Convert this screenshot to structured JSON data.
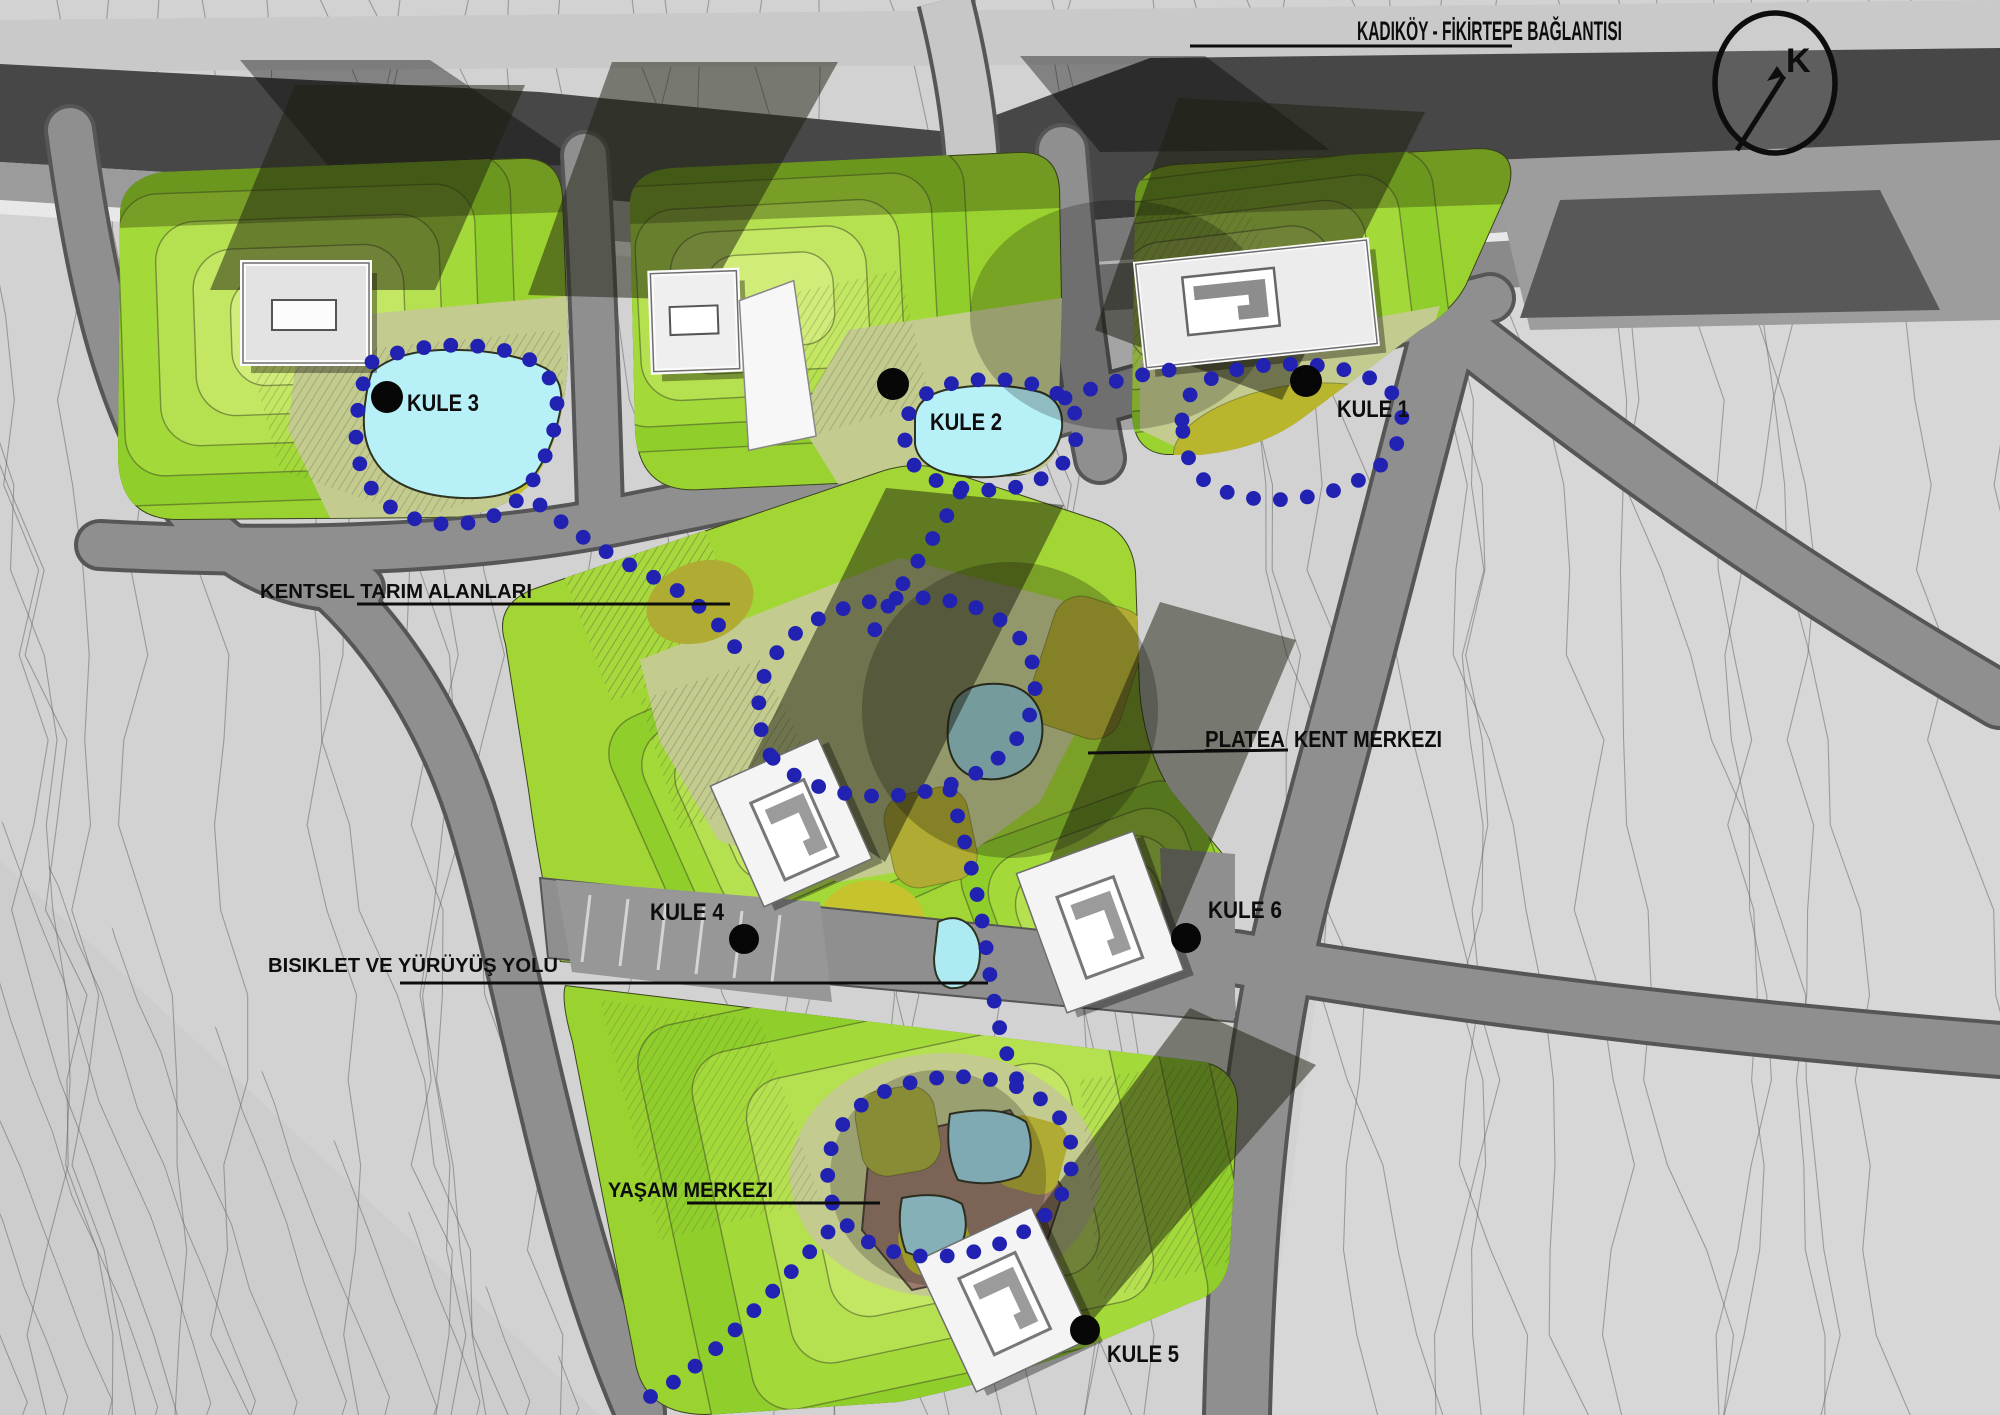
{
  "title": "PLATEA Kent Merkezi vaziyet planı",
  "labels": {
    "connection": "KADIKÖY - FİKİRTEPE BAĞLANTISI",
    "kule1": "KULE 1",
    "kule2": "KULE 2",
    "kule3": "KULE 3",
    "kule4": "KULE 4",
    "kule5": "KULE 5",
    "kule6": "KULE 6",
    "farming": "KENTSEL TARIM ALANLARI",
    "platea": "PLATEA",
    "kent_merkezi": "KENT MERKEZI",
    "bike": "BISIKLET VE YÜRÜYÜŞ YOLU",
    "life_center": "YAŞAM MERKEZI"
  },
  "compass": {
    "letter": "K"
  },
  "colors": {
    "background": "#d2d2d2",
    "contour_line": "#5f5f5f",
    "highway_dark": "#474747",
    "road_gray": "#8f8f8f",
    "road_edge": "#565656",
    "ramp_light": "#c7c7c7",
    "parcel_green": "#9ad22f",
    "terrace_greens": [
      "#8fce2b",
      "#a4d93a",
      "#b5e04f",
      "#c4e763",
      "#d2ec79"
    ],
    "sage": "#c4cb8f",
    "olive": "#b0ab33",
    "yellow_mound": "#c6c32e",
    "pond_cyan": "#b7f1f7",
    "pond_muted": "#9ccfd6",
    "deck_brown": "#9a7b6c",
    "building_fill": "#ededed",
    "building_core": "#ffffff",
    "core_dark": "#8d8d8d",
    "shadow": "rgba(28,30,14,0.50)",
    "path_dot_blue": "#2121b2",
    "label_black": "#0d0d0d",
    "label_red": "#e8150d"
  }
}
